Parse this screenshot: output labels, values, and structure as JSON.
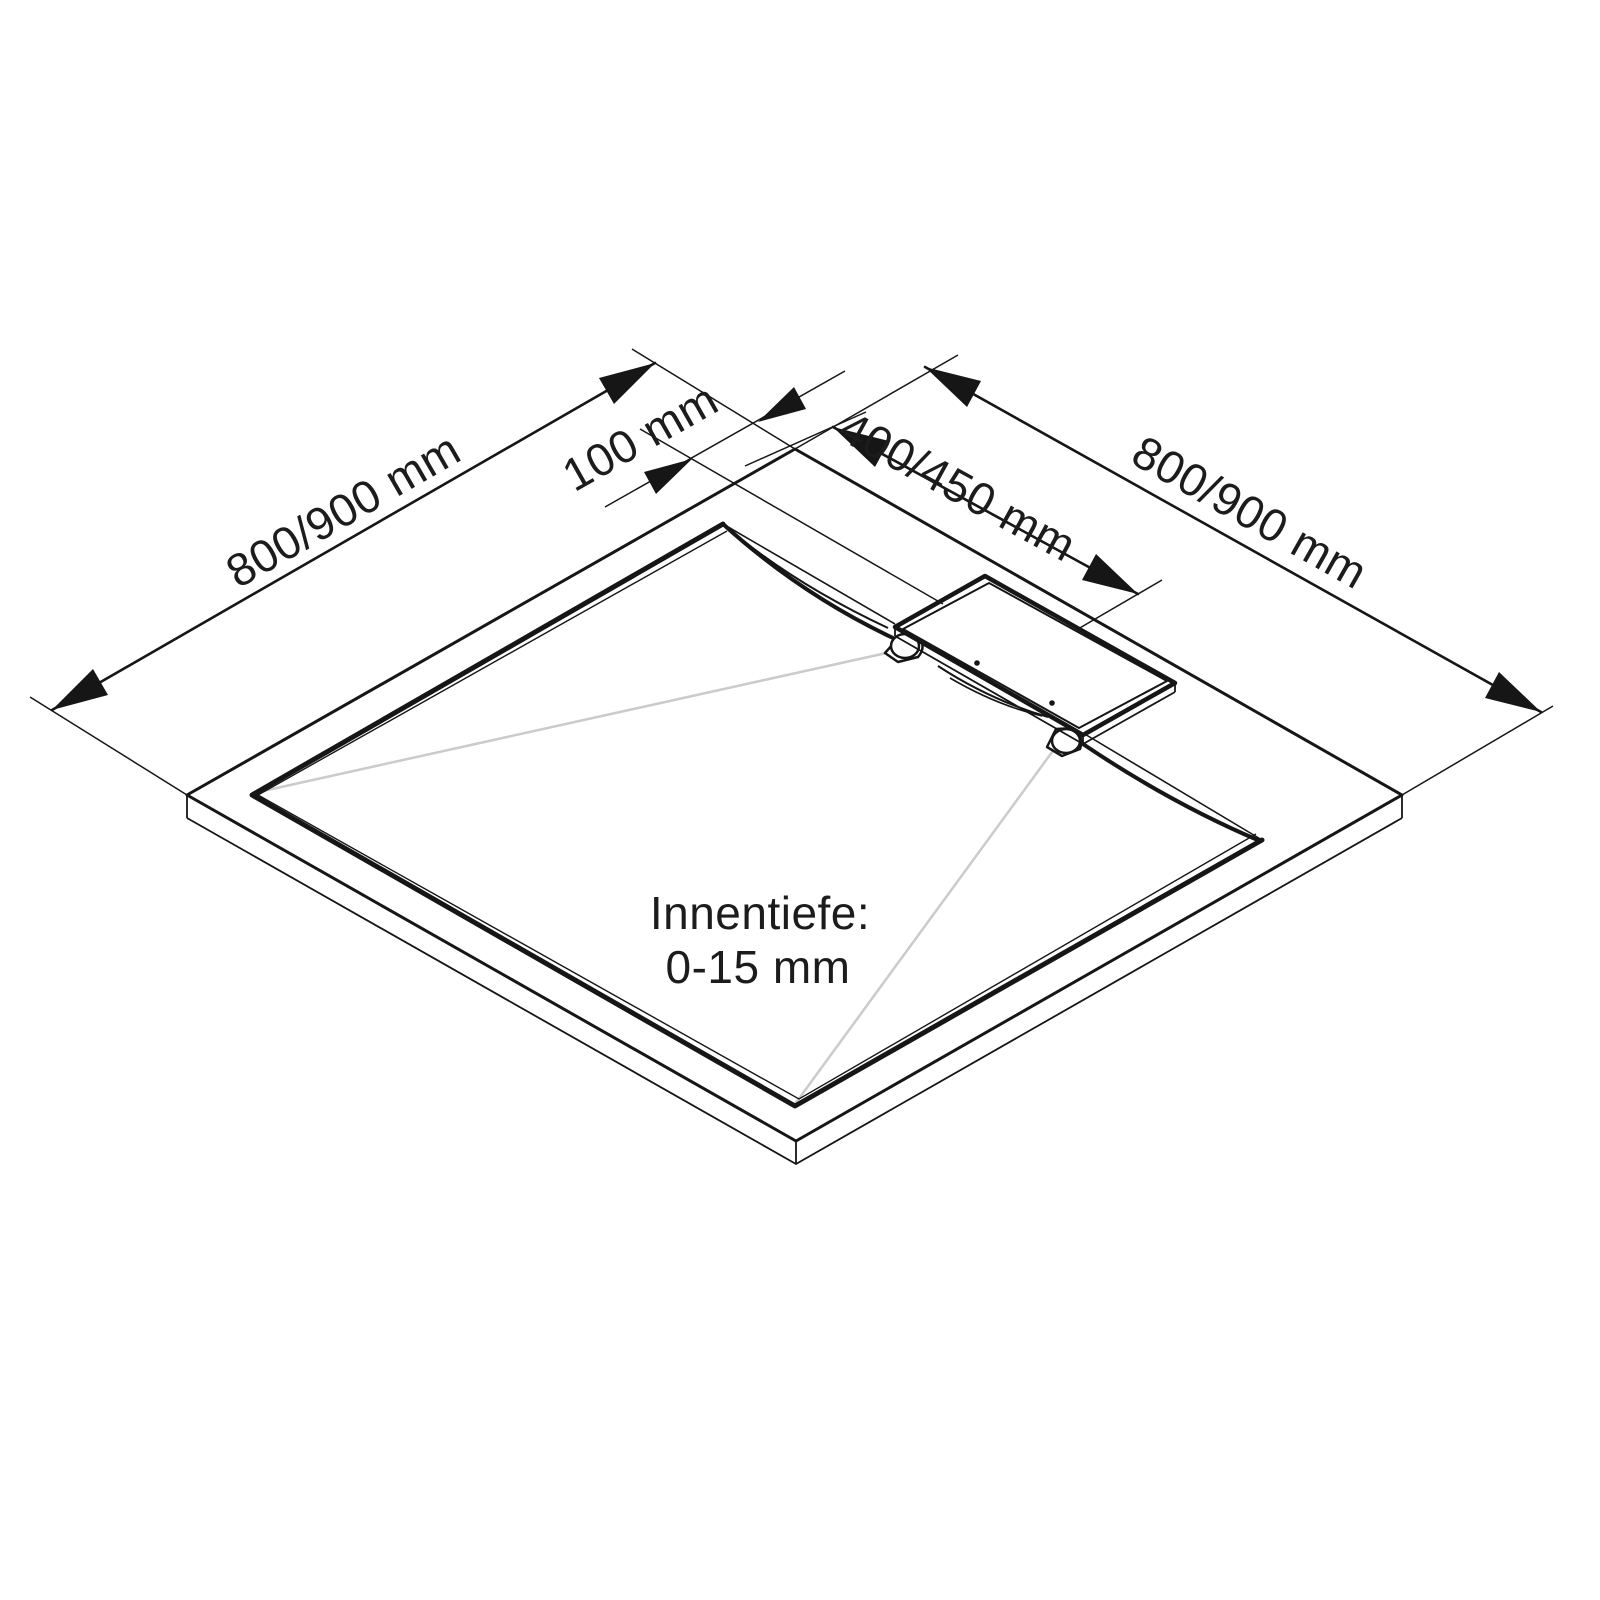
{
  "diagram": {
    "kind": "shower-tray-isometric-dimension-drawing",
    "labels": {
      "dim_left": "800/900 mm",
      "dim_right": "800/900 mm",
      "dim_corner_offset": "100 mm",
      "dim_drain": "400/450 mm",
      "depth_line1": "Innentiefe:",
      "depth_line2": "0-15 mm"
    },
    "colors": {
      "line": "#161616",
      "fold": "#cbcbcb",
      "text": "#1c1c1c",
      "bg": "#ffffff"
    }
  }
}
